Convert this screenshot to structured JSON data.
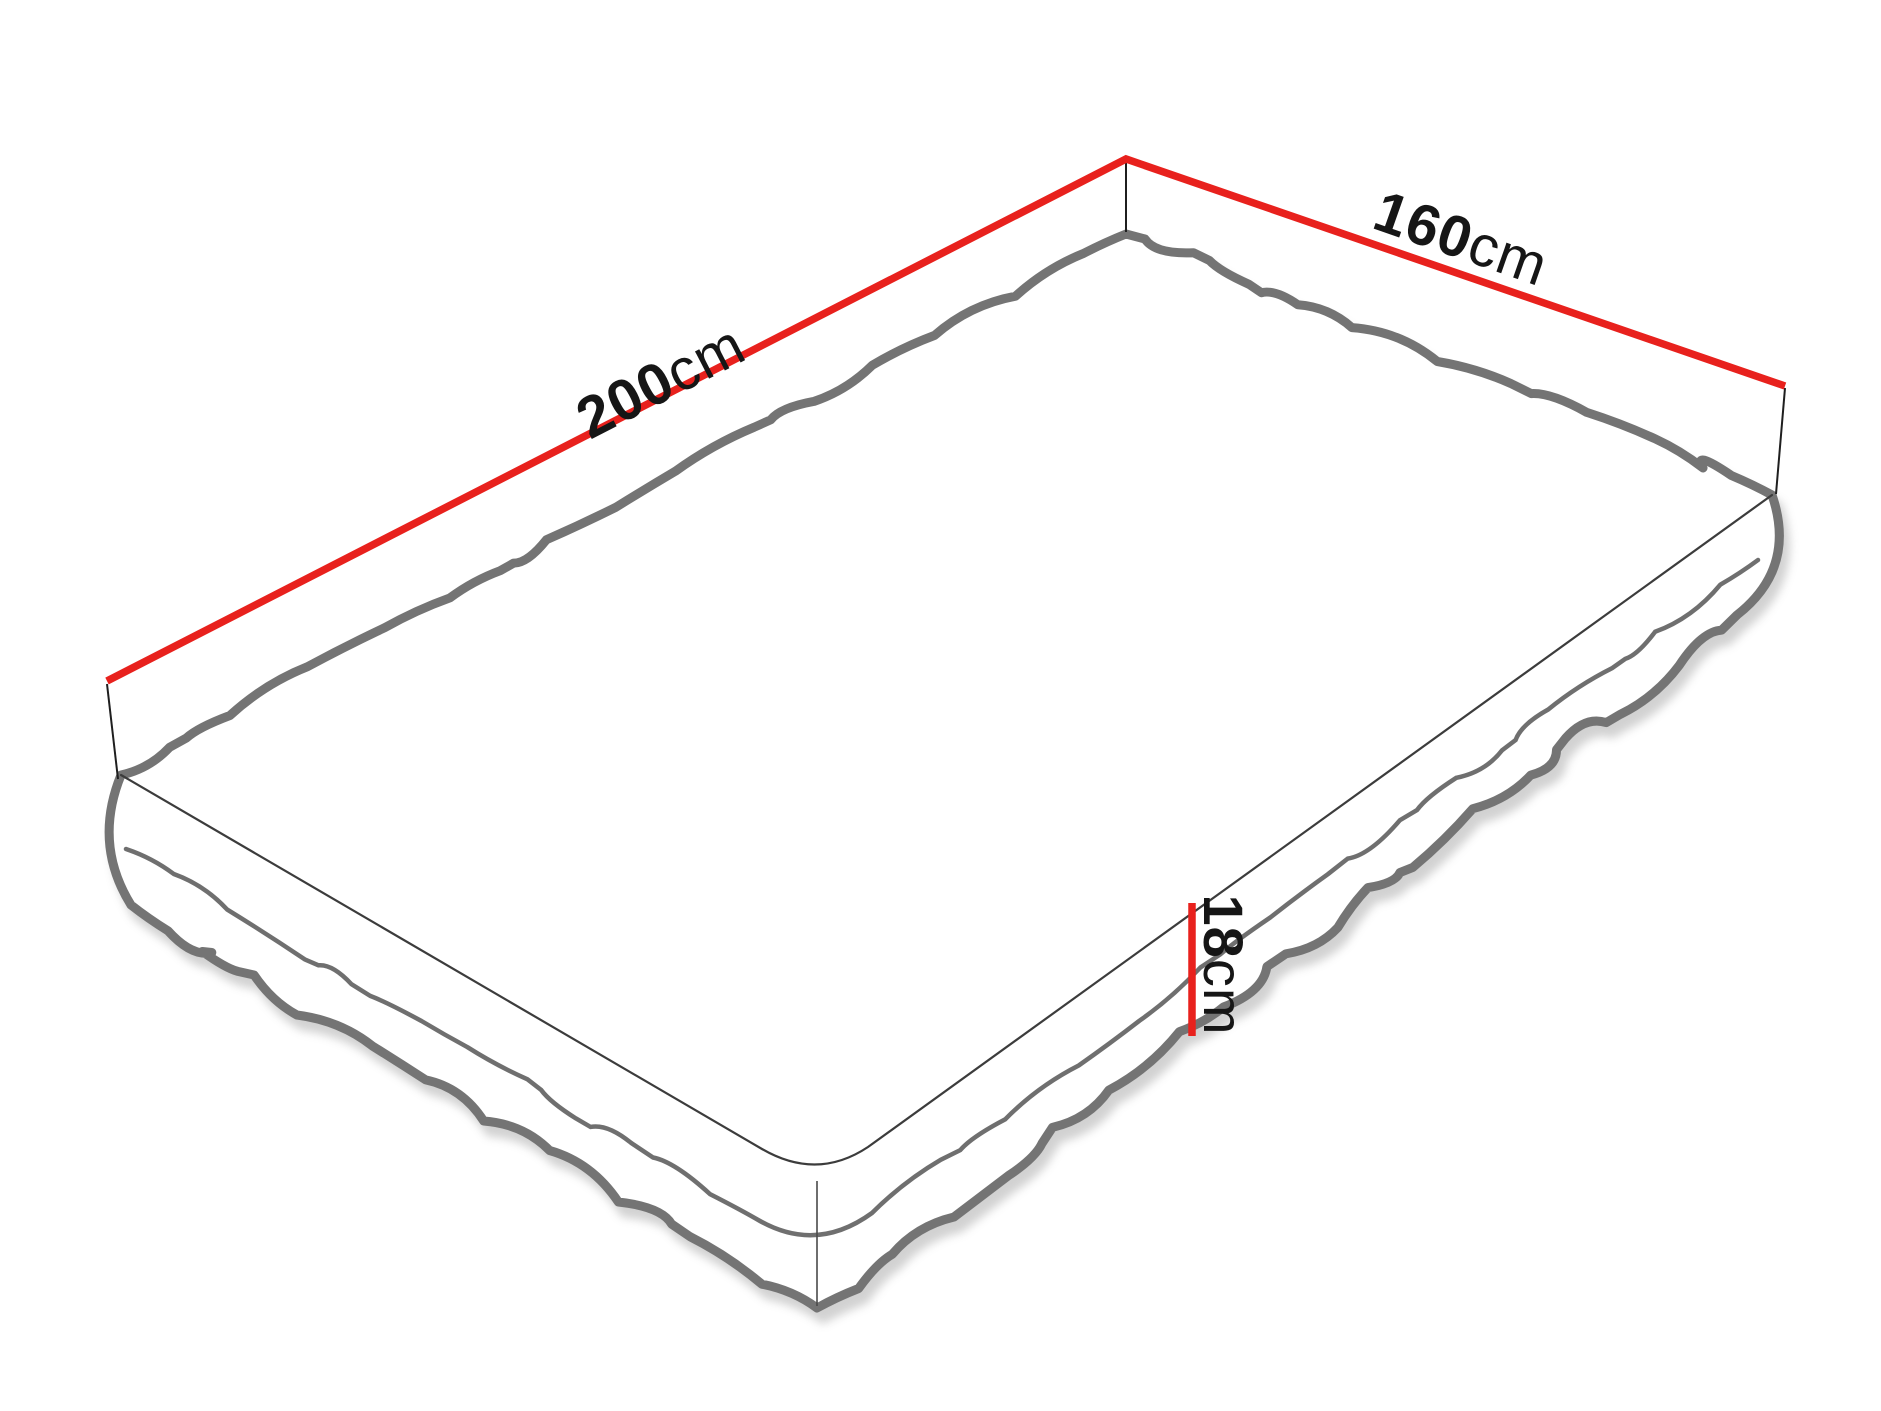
{
  "figure": {
    "kind": "mattress-dimension-diagram",
    "labels": {
      "length": {
        "value": "200",
        "unit": "cm"
      },
      "width": {
        "value": "160",
        "unit": "cm"
      },
      "height": {
        "value": "18",
        "unit": "cm"
      }
    },
    "colors": {
      "dimension_line": "#E8211D",
      "outline": "#747474",
      "seam": "#6F6F6F",
      "near_edge": "#3C3C3C",
      "tick": "#1F1F1F",
      "corner_seam": "#4A4A4A",
      "shadow": "#9B9B9B",
      "text": "#161616",
      "background": "#FFFFFF"
    }
  }
}
